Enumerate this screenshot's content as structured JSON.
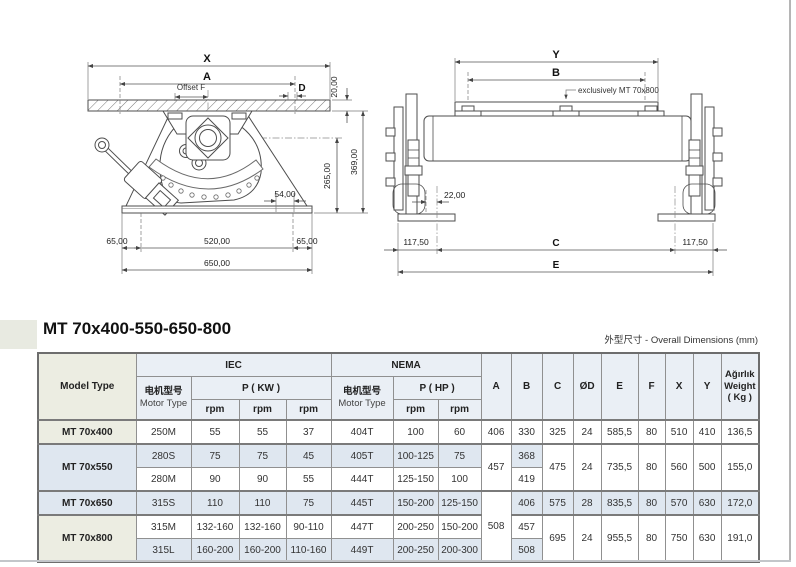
{
  "page": {
    "title": "MT 70x400-550-650-800",
    "dims_note": "外型尺寸 - Overall Dimensions (mm)"
  },
  "front_view": {
    "dim_x": "X",
    "dim_a": "A",
    "offset_f": "Offset F",
    "dim_d": "D",
    "plate_thickness": "20,00",
    "height_total": "369,00",
    "height_pivot": "265,00",
    "slot": "54,00",
    "base_left": "65,00",
    "base_center": "520,00",
    "base_right": "65,00",
    "base_total": "650,00"
  },
  "side_view": {
    "dim_y": "Y",
    "dim_b": "B",
    "note": "exclusively MT 70x800",
    "offset": "22,00",
    "foot_left": "117,50",
    "dim_c": "C",
    "foot_right": "117,50",
    "dim_e": "E"
  },
  "table": {
    "header": {
      "model_type": "Model Type",
      "iec": "IEC",
      "nema": "NEMA",
      "motor_cn": "电机型号",
      "motor_en": "Motor Type",
      "p_kw": "P ( KW )",
      "p_hp": "P ( HP )",
      "rpm": "rpm",
      "a": "A",
      "b": "B",
      "c": "C",
      "od": "ØD",
      "e": "E",
      "f": "F",
      "x": "X",
      "y": "Y",
      "weight_tr": "Ağırlık",
      "weight_en": "Weight",
      "weight_unit": "( Kg )"
    },
    "rows": [
      {
        "model": "MT 70x400",
        "motor_iec": "250M",
        "kw1": "55",
        "kw2": "55",
        "kw3": "37",
        "motor_nema": "404T",
        "hp1": "100",
        "hp2": "60",
        "a": "406",
        "b": "330",
        "c": "325",
        "od": "24",
        "e": "585,5",
        "f": "80",
        "x": "510",
        "y": "410",
        "w": "136,5"
      },
      {
        "model": "MT 70x550",
        "motor_iec": "280S",
        "kw1": "75",
        "kw2": "75",
        "kw3": "45",
        "motor_nema": "405T",
        "hp1": "100-125",
        "hp2": "75",
        "a": "457",
        "b": "368",
        "c": "475",
        "od": "24",
        "e": "735,5",
        "f": "80",
        "x": "560",
        "y": "500",
        "w": "155,0"
      },
      {
        "motor_iec": "280M",
        "kw1": "90",
        "kw2": "90",
        "kw3": "55",
        "motor_nema": "444T",
        "hp1": "125-150",
        "hp2": "100",
        "b": "419"
      },
      {
        "model": "MT 70x650",
        "motor_iec": "315S",
        "kw1": "110",
        "kw2": "110",
        "kw3": "75",
        "motor_nema": "445T",
        "hp1": "150-200",
        "hp2": "125-150",
        "a": "508",
        "b": "406",
        "c": "575",
        "od": "28",
        "e": "835,5",
        "f": "80",
        "x": "570",
        "y": "630",
        "w": "172,0"
      },
      {
        "model": "MT 70x800",
        "motor_iec": "315M",
        "kw1": "132-160",
        "kw2": "132-160",
        "kw3": "90-110",
        "motor_nema": "447T",
        "hp1": "200-250",
        "hp2": "150-200",
        "b": "457",
        "c": "695",
        "od": "24",
        "e": "955,5",
        "f": "80",
        "x": "750",
        "y": "630",
        "w": "191,0"
      },
      {
        "motor_iec": "315L",
        "kw1": "160-200",
        "kw2": "160-200",
        "kw3": "110-160",
        "motor_nema": "449T",
        "hp1": "200-250",
        "hp2": "200-300",
        "b": "508"
      }
    ]
  }
}
